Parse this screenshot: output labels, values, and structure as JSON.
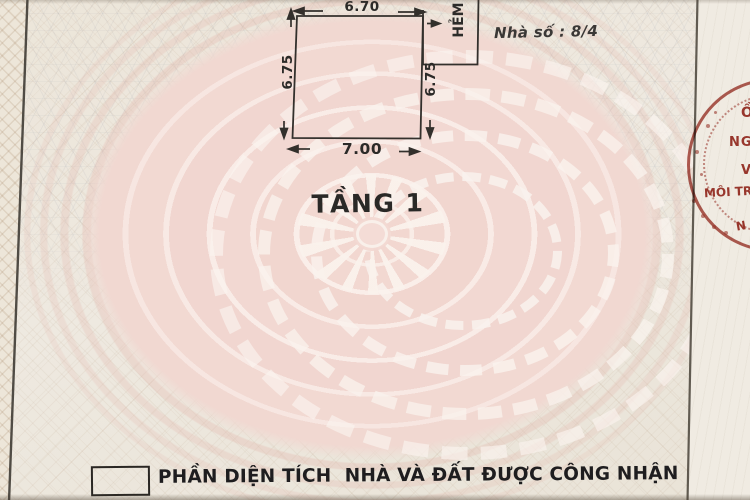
{
  "plan": {
    "floor_label": "TẦNG 1",
    "house_number": "Nhà số : 8/4",
    "alley_label": "HẺM",
    "dimensions": {
      "top": "6.70",
      "left": "6.75",
      "right": "6.75",
      "bottom": "7.00"
    }
  },
  "legend": {
    "text": "PHẦN DIỆN TÍCH  NHÀ VÀ ĐẤT ĐƯỢC CÔNG NHẬN"
  },
  "stamp": {
    "fragments": [
      "Ồ",
      "NG",
      "V",
      "MÔI TR",
      "N"
    ],
    "color": "#a23a31"
  },
  "colors": {
    "paper": "#ece6db",
    "ink": "#2e2c2a",
    "pattern_pink": "#f2d8d1",
    "stamp_red": "#a23a31"
  }
}
